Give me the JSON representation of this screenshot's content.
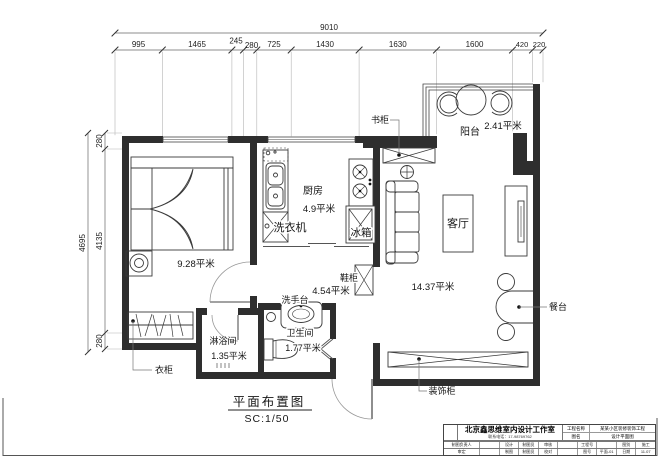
{
  "sheet": {
    "title": "平面布置图",
    "scale_label": "SC:1/50"
  },
  "dimensions": {
    "top_total": "9010",
    "top_segments": [
      "995",
      "1465",
      "245",
      "280",
      "725",
      "1430",
      "1630",
      "1600",
      "420",
      "220"
    ],
    "left_total": "4695",
    "left_segments": [
      "280",
      "4135",
      "280"
    ]
  },
  "rooms": {
    "bedroom": {
      "area": "9.28平米"
    },
    "kitchen": {
      "name": "厨房",
      "area": "4.9平米"
    },
    "living": {
      "name": "客厅",
      "area": "14.37平米"
    },
    "balcony": {
      "name": "阳台",
      "area": "2.41平米"
    },
    "hall": {
      "area": "4.54平米"
    },
    "bathroom": {
      "name": "卫生间",
      "area": "1.77平米"
    },
    "shower": {
      "name": "淋浴间",
      "area": "1.35平米"
    }
  },
  "fixtures": {
    "washing_machine": "洗衣机",
    "fridge": "冰箱",
    "bookcase": "书柜",
    "shoe_cabinet": "鞋柜",
    "washbasin": "洗手台",
    "wardrobe": "衣柜",
    "dining_table": "餐台",
    "decor_cabinet": "装饰柜"
  },
  "title_block": {
    "company": "北京鑫思维室内设计工作室",
    "phone": "联系电话：17-98769762",
    "project_label": "工程名称",
    "project_value": "某某小区装修装饰工程",
    "drawing_label": "图名",
    "drawing_value": "设计平面图",
    "row2": [
      "制图负责人",
      "",
      "设计",
      "制图员",
      "审核",
      "",
      "工程号",
      "",
      "图别",
      "施工"
    ],
    "row3": [
      "审定",
      "",
      "制图",
      "制图员",
      "校对",
      "",
      "图号",
      "平面-01",
      "日期",
      "11.07"
    ]
  },
  "colors": {
    "wall": "#2e2e2e",
    "line": "#444444",
    "thin": "#9a9a9a"
  }
}
